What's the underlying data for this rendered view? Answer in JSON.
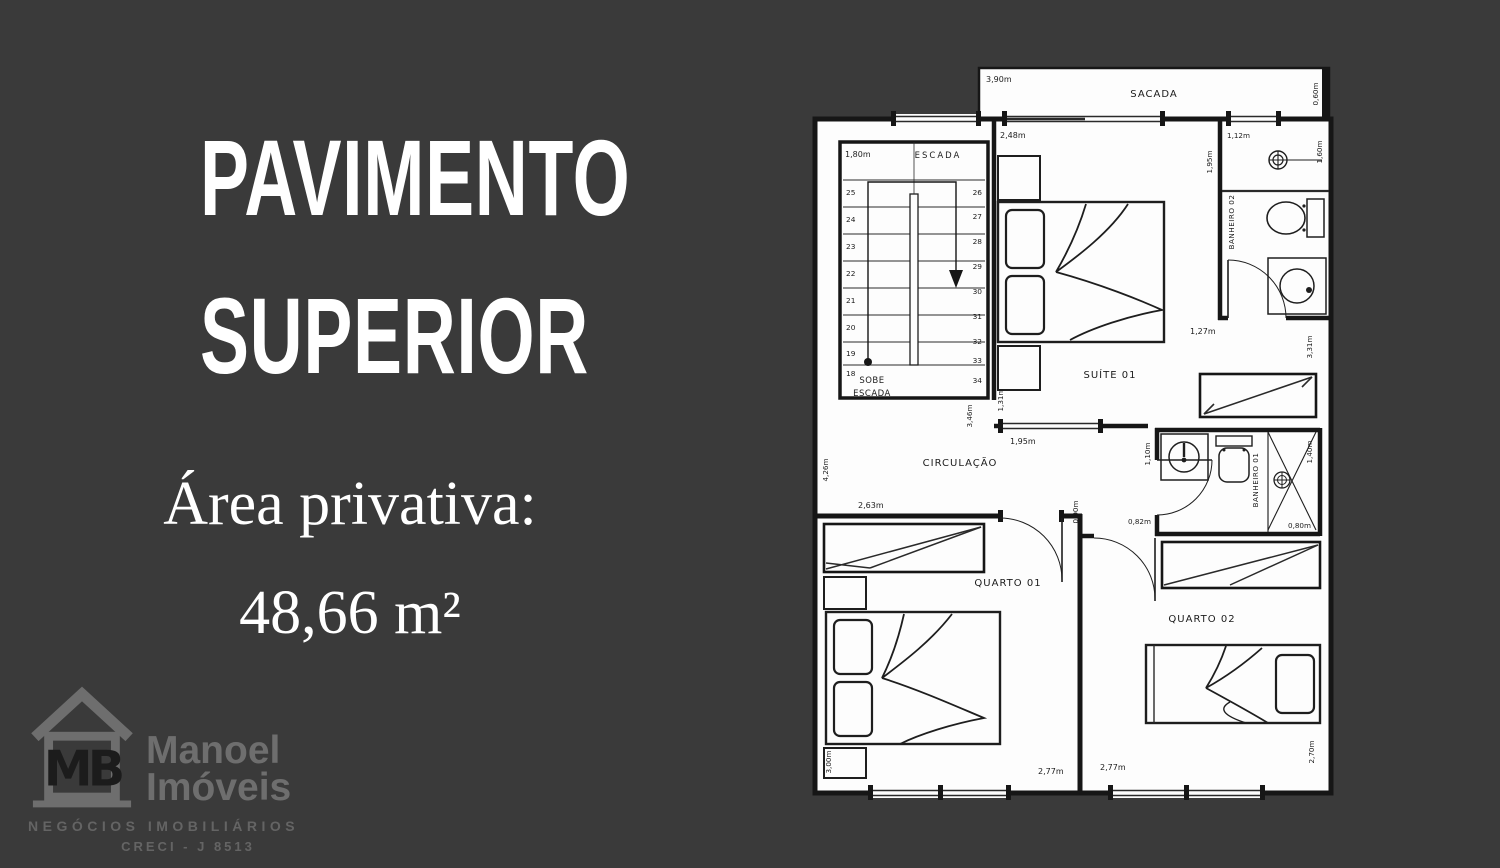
{
  "page": {
    "background": "#3a3a3a",
    "text_color": "#ffffff"
  },
  "left_panel": {
    "title_line1": "PAVIMENTO",
    "title_line2": "SUPERIOR",
    "area_label": "Área privativa:",
    "area_value": "48,66 m²"
  },
  "logo": {
    "monogram": "MB",
    "name_line1": "Manoel",
    "name_line2": "Imóveis",
    "tagline": "NEGÓCIOS IMOBILIÁRIOS",
    "creci": "CRECI - J 8513",
    "color": "#6e6e6e"
  },
  "plan": {
    "rooms": {
      "sacada": "SACADA",
      "escada": "ESCADA",
      "sobe_line1": "SOBE",
      "sobe_line2": "ESCADA",
      "suite": "SUÍTE 01",
      "banheiro2": "BANHEIRO 02",
      "circulacao": "CIRCULAÇÃO",
      "banheiro1": "BANHEIRO 01",
      "quarto1": "QUARTO 01",
      "quarto2": "QUARTO 02"
    },
    "dims": {
      "sacada_w": "3,90m",
      "sacada_d": "0,60m",
      "escada_w": "1,80m",
      "suite_w": "2,48m",
      "suite_d": "1,95m",
      "suite_side": "1,31m",
      "ban2_w": "1,12m",
      "ban2_d": "1,60m",
      "ban2_below_w": "1,27m",
      "ban2_below_d": "3,31m",
      "circ_inner_d": "3,46m",
      "circ_inner_w": "1,95m",
      "circ_d": "4,26m",
      "circ_w": "2,63m",
      "ban1_left": "1,10m",
      "ban1_right": "1,40m",
      "ban1_w": "0,82m",
      "ban1_shower": "0,80m",
      "hall_w": "0,90m",
      "q1_d": "3,00m",
      "q1_w": "2,77m",
      "q2_w": "2,77m",
      "q2_d": "2,70m"
    },
    "stairs": {
      "left": [
        "25",
        "24",
        "23",
        "22",
        "21",
        "20",
        "19",
        "18"
      ],
      "right": [
        "26",
        "27",
        "28",
        "29",
        "30",
        "31",
        "32",
        "33",
        "34"
      ]
    }
  }
}
